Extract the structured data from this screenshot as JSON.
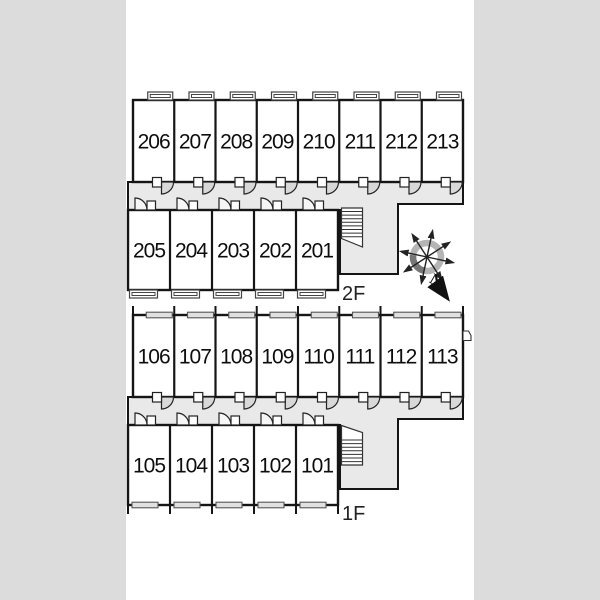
{
  "colors": {
    "page_margin": "#dcdcdc",
    "sheet": "#ffffff",
    "wall": "#151515",
    "corridor": "#e9e9e9",
    "window_frame": "#444444",
    "door_fan": "#d8d8d8",
    "compass_ring": "#b5b5b5",
    "compass_ring_dark": "#777777"
  },
  "floors": [
    {
      "label": "2F",
      "upper_row_rooms": [
        "206",
        "207",
        "208",
        "209",
        "210",
        "211",
        "212",
        "213"
      ],
      "lower_row_rooms": [
        "205",
        "204",
        "203",
        "202",
        "201"
      ],
      "window_style": "protruding",
      "has_staircase": true
    },
    {
      "label": "1F",
      "upper_row_rooms": [
        "106",
        "107",
        "108",
        "109",
        "110",
        "111",
        "112",
        "113"
      ],
      "lower_row_rooms": [
        "105",
        "104",
        "103",
        "102",
        "101"
      ],
      "window_style": "flush",
      "side_door_room": "113",
      "has_staircase": true
    }
  ],
  "compass": {
    "north_label": "N",
    "orientation": "north-lower-right"
  }
}
